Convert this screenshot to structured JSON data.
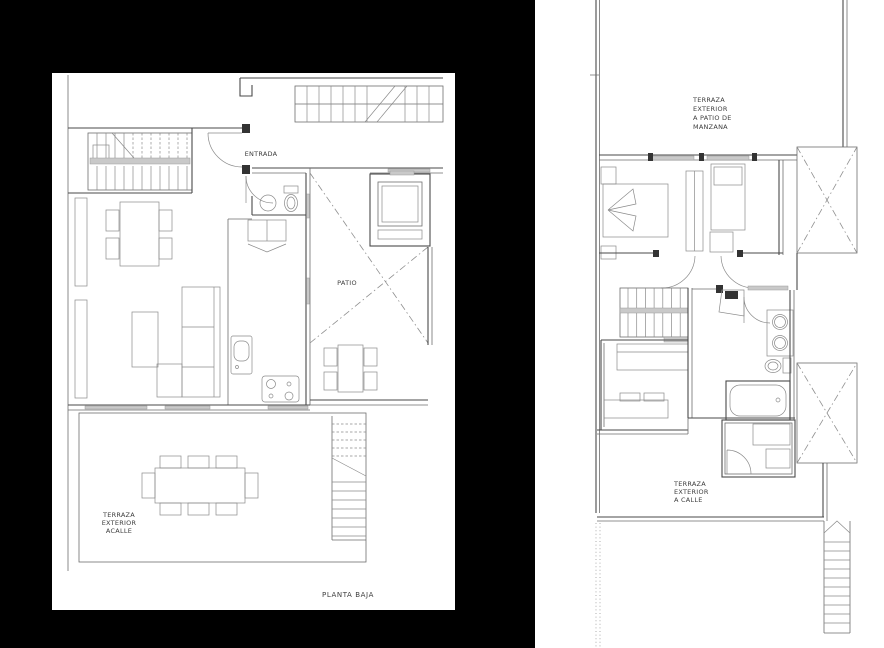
{
  "canvas": {
    "width": 884,
    "height": 648,
    "background": "#000000",
    "sheet_color": "#ffffff"
  },
  "colors": {
    "wall": "#4a4a4a",
    "furniture": "#8a8a8a",
    "gray_fill": "#c9c9c9",
    "text": "#3d3d3d"
  },
  "left_plan": {
    "title": "PLANTA BAJA",
    "labels": {
      "entrada": "ENTRADA",
      "patio": "PATIO",
      "terraza_calle": [
        "TERRAZA",
        "EXTERIOR",
        "ACALLE"
      ]
    }
  },
  "right_plan": {
    "labels": {
      "terraza_manzana": [
        "TERRAZA",
        "EXTERIOR",
        "A PATIO DE",
        "MANZANA"
      ],
      "terraza_calle": [
        "TERRAZA",
        "EXTERIOR",
        "A CALLE"
      ]
    }
  }
}
